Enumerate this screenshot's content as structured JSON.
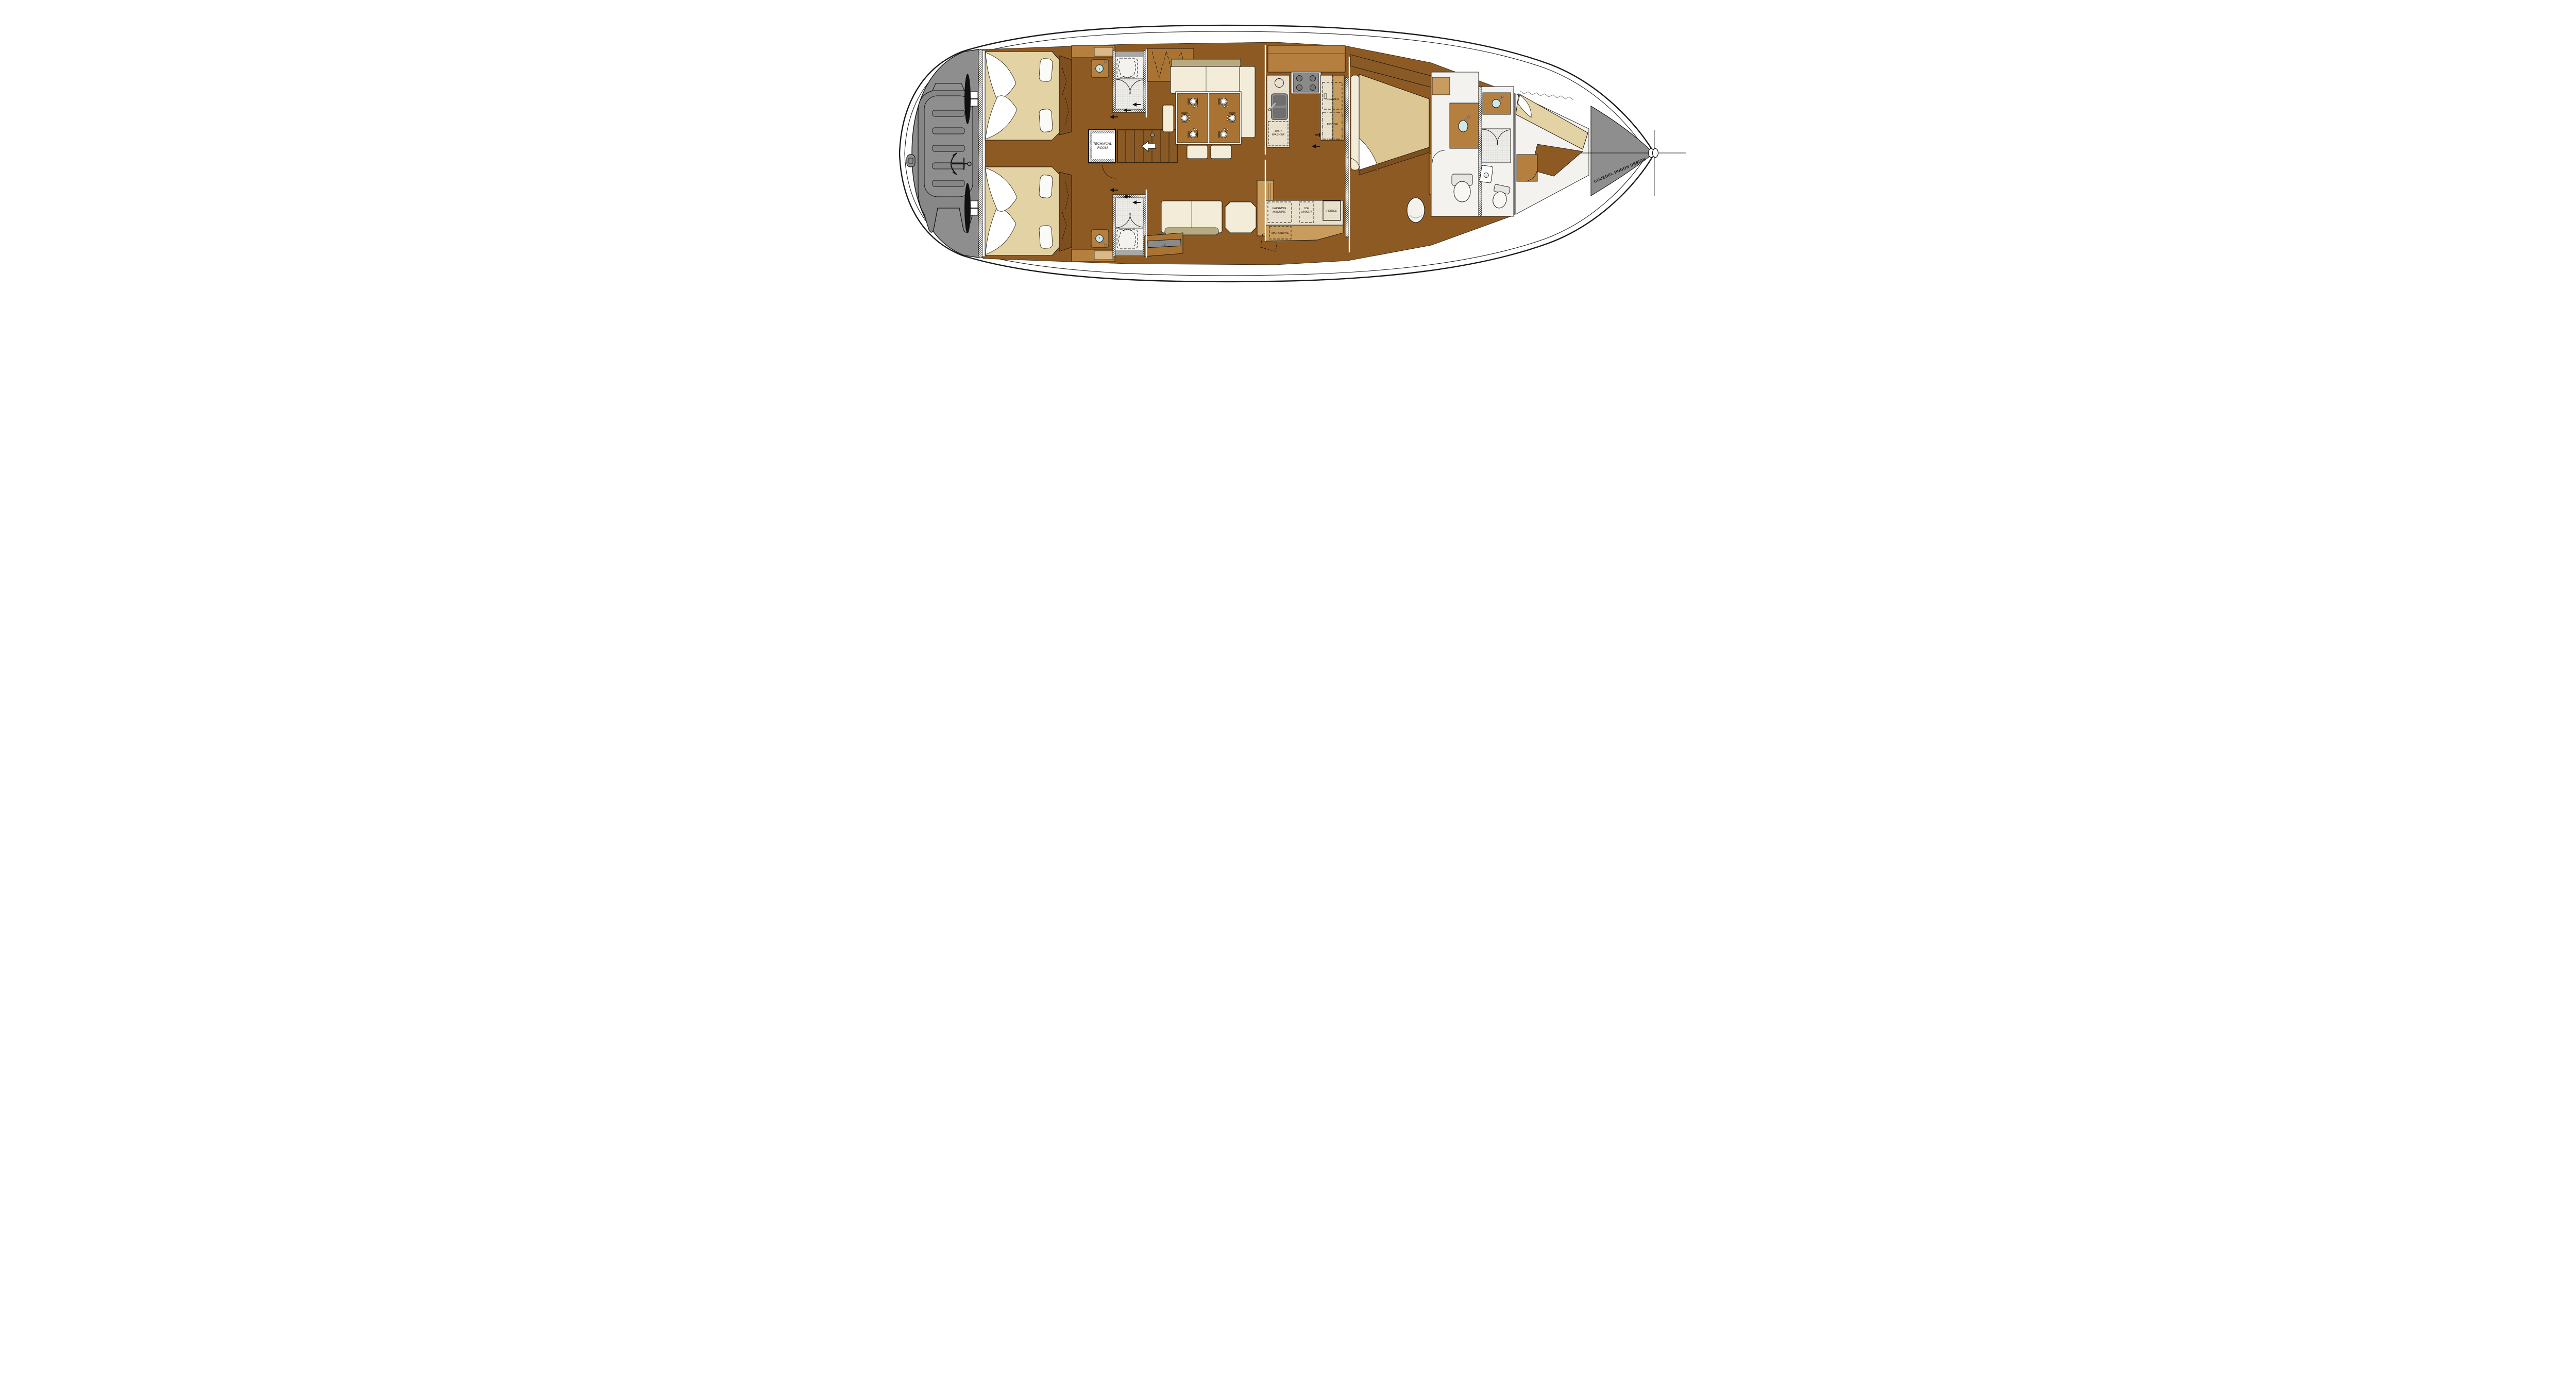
{
  "title": "Sailing yacht interior layout plan",
  "designer_credit": "COUEDEL HUGON DESIGN",
  "labels": {
    "technical_room": [
      "TECHNICAL",
      "ROOM"
    ],
    "dish_washer": [
      "DISH",
      "WASHER"
    ],
    "freezer": "FREEZER",
    "fridge_upper": "FRIDGE",
    "washing_machine": [
      "WASHING",
      "MACHINE"
    ],
    "ice_maker": [
      "ICE",
      "MAKER"
    ],
    "fridge_lower": "FRIDGE",
    "microwave": "MICROWAVE",
    "tv": "TV"
  },
  "colors": {
    "hull_outline": "#1a1a1a",
    "deck_grey": "#8e8e8e",
    "floor_wood": "#8d5a24",
    "cabin_wood": "#9a6629",
    "furniture_wood": "#b5803f",
    "light_wood": "#d9b98a",
    "dark_wood": "#7d4e1f",
    "berth_tan": "#e3d2a4",
    "cushion_cream": "#f2ecd8",
    "bolster_khaki": "#b7aa80",
    "counter_cream": "#e9e1cd",
    "appliance_grey": "#8a8a8a",
    "sink_blue": "#cfe9ea",
    "fixture_white": "#f8f7f3"
  }
}
